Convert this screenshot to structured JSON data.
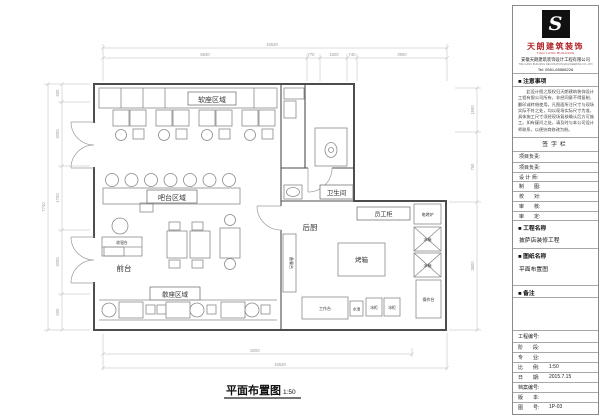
{
  "colors": {
    "brand_red": "#b01f24",
    "line": "#4d4d4d",
    "dim_gray": "#9a9a9a"
  },
  "title_block": {
    "brand": {
      "logo_letter": "S",
      "name": "天朗建筑装饰",
      "name_en": "TIAN LANG BUILDING",
      "company": "安徽天朗建筑装饰设计工程有限公司",
      "company_en": "TIAN LANG BUILDING DECORATION ENGINEERING CO.,LTD",
      "tel": "Tel: 0551-65568226"
    },
    "notice": {
      "header": "■ 注意事项",
      "body": "此设计图之版权归天朗建筑装饰设计工程有限公司所有，非经同意不得复制、翻印或转借使用。凡图面所注尺寸与现场实际不符之处，均以现场实际尺寸为准，具体施工尺寸须经现场复核确认后方可施工。如有疑问之处，请及时与本公司设计师联系，以便协商修改为盼。"
    },
    "signature": {
      "header": "签字栏",
      "rows": [
        {
          "label": "项目负责:"
        },
        {
          "label": "项目负责:"
        },
        {
          "label": "设 计 师:"
        },
        {
          "label": "制　　图:"
        },
        {
          "label": "校　　对:"
        },
        {
          "label": "审　　核:"
        },
        {
          "label": "审　　定:"
        }
      ]
    },
    "project": {
      "header": "■ 工程名称",
      "value": "披萨店装修工程"
    },
    "drawing": {
      "header": "■ 图纸名称",
      "value": "平面布置图"
    },
    "remark": {
      "header": "■ 备注"
    },
    "info_rows": [
      {
        "label": "工程编号:",
        "value": ""
      },
      {
        "label": "阶　　段:",
        "value": ""
      },
      {
        "label": "专　　业:",
        "value": ""
      },
      {
        "label": "比　　例:",
        "value": "1:50"
      },
      {
        "label": "日　　期:",
        "value": "2015.7.15"
      },
      {
        "label": "档案编号:",
        "value": ""
      },
      {
        "label": "版　　本:",
        "value": ""
      },
      {
        "label": "图　　号:",
        "value": "1P-03"
      }
    ]
  },
  "plan": {
    "title": "平面布置图",
    "scale": "1:50",
    "labels": {
      "soft_seating": "软座区域",
      "bar": "吧台区域",
      "open_seating": "散座区域",
      "front_desk": "前台",
      "kitchen": "后厨",
      "bathroom": "卫生间",
      "staff_cabinet": "员工柜",
      "oven": "烤箱",
      "cashier": "收银台",
      "prep_cabinet": "备餐台",
      "electric_oven": "电烤炉",
      "fridge_a": "冰箱",
      "fridge_b": "冰箱",
      "console": "操作台",
      "work_table": "工作台",
      "sink": "水池",
      "freezer_a": "冰柜",
      "freezer_b": "冰柜"
    },
    "dims": {
      "top_overall": "15530",
      "top_segments": [
        "6630",
        "770",
        "1500",
        "740",
        "3900"
      ],
      "bottom_inner": "8200",
      "bottom_overall": "15530",
      "left_overall": "7740",
      "left_segments": [
        "600",
        "2000",
        "1700",
        "2000",
        "600"
      ],
      "right_segments": [
        "1500",
        "750",
        "3800"
      ]
    }
  }
}
